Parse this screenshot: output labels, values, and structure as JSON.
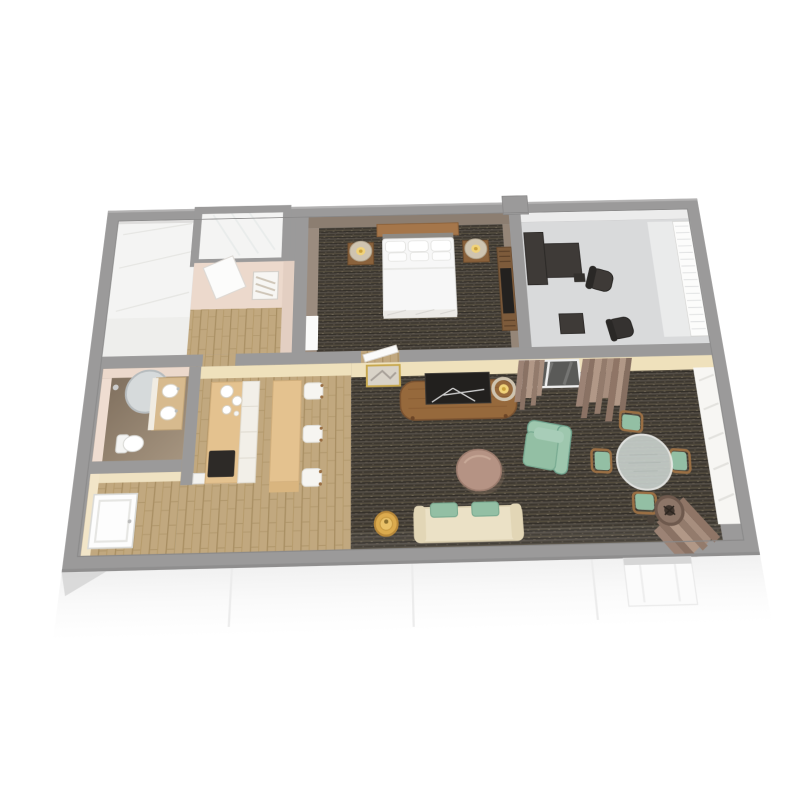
{
  "scene": {
    "type": "3d-floorplan-render",
    "description": "Isometric cutaway 3D floor plan of a one-bedroom suite with bathroom, walk-in shower, bedroom, work room, kitchen with breakfast bar, and combined living-dining room",
    "background": "#ffffff"
  },
  "palette": {
    "wallGray": "#9b9a9a",
    "wallGrayDark": "#8a8989",
    "wallGrayLight": "#b3b2b2",
    "creamWall": "#efe1bc",
    "taupeWall": "#8c7e71",
    "taupeWallLight": "#9b8c7f",
    "pinkWall": "#ecd9cc",
    "whiteRoom": "#f4f4f3",
    "officeFloor": "#d9dadb",
    "officeWallFace": "#ececec",
    "carpetBase": "#48423a",
    "carpetDark": "#2e2a24",
    "carpetLight": "#59513f",
    "wood": "#c1a87f",
    "woodLine": "#a78d61",
    "cabinetTan": "#e4c28f",
    "counterFace": "#f2efe8",
    "cooktopBlack": "#2d2a27",
    "darkFurniture": "#3e3a37",
    "teal": "#9ec7ae",
    "tealSeat": "#93bfa4",
    "tealDark": "#6fa28d",
    "consoleWood": "#96693c",
    "headboardWood": "#a5764a",
    "nightstandWood": "#8a623c",
    "dresserWood": "#7d5b3b",
    "benchCream": "#ebe1c6",
    "gold": "#dcab4e",
    "coffeeTable": "#b59384",
    "glassTable": "#c9d1cd",
    "curtain": "#9c8375",
    "curtainDark": "#8a7264",
    "curtainLight": "#b19887",
    "bedWhite": "#f7f7f7",
    "mirror": "#d6dadb",
    "glow": "#f0d27a",
    "windowDark": "#5a5a58",
    "bathFloorDark": "#7c6c5b",
    "bathFloorLight": "#a5947f",
    "exteriorFace": "#f6f6f6"
  },
  "rooms": [
    {
      "id": "closet-laundry",
      "label": "Closet / laundry room"
    },
    {
      "id": "shower",
      "label": "Walk-in shower"
    },
    {
      "id": "bath-hall",
      "label": "Bathroom hallway"
    },
    {
      "id": "bedroom",
      "label": "Bedroom"
    },
    {
      "id": "office",
      "label": "Work / sitting room"
    },
    {
      "id": "vanity-bathroom",
      "label": "Vanity bathroom"
    },
    {
      "id": "entry",
      "label": "Entry"
    },
    {
      "id": "kitchen",
      "label": "Kitchen with breakfast bar"
    },
    {
      "id": "living-dining",
      "label": "Living / dining room"
    }
  ],
  "furniture": {
    "bedroom": [
      "queen bed with white bedding",
      "wood headboard",
      "two nightstands",
      "two drum-shade lamps",
      "dresser with TV"
    ],
    "office": [
      "L-shaped dark desk",
      "office chair",
      "side table",
      "second chair",
      "window with blinds"
    ],
    "kitchen": [
      "counter with cooktop",
      "coffee service",
      "breakfast bar island",
      "three white stools"
    ],
    "vanity_bathroom": [
      "round mirror",
      "vanity with two sinks",
      "toilet"
    ],
    "living_dining": [
      "media console with TV",
      "framed art",
      "table lamp",
      "round coffee table",
      "teal armchair",
      "round glass dining table",
      "four teal dining chairs",
      "cream bench sofa with teal cushions",
      "gold side table",
      "floor lamp",
      "curtained windows"
    ],
    "entry": [
      "entry door",
      "towel shelf"
    ]
  }
}
